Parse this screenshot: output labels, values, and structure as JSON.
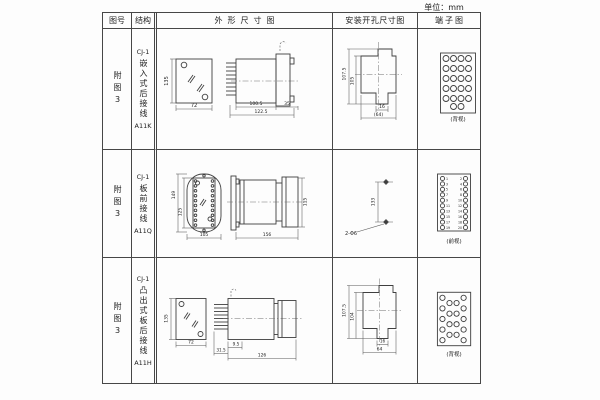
{
  "unit_label": "单位：mm",
  "headers": {
    "fig_no": "图号",
    "structure": "结构",
    "outline": "外形尺寸图",
    "mounting": "安装开孔尺寸图",
    "terminal": "端子图"
  },
  "rows": [
    {
      "fig_no": "附图3",
      "model": "CJ-1",
      "structure_text": "嵌入式后接线",
      "code": "A11K",
      "outline_dims": {
        "height": "135",
        "width": "72",
        "depth_body": "100.5",
        "depth_total": "122.5",
        "flange": "35"
      },
      "mounting_dims": {
        "outer": "107.5",
        "inner": "105",
        "notch": "16",
        "width": "(64)"
      },
      "terminal_caption": "(背视)"
    },
    {
      "fig_no": "附图3",
      "model": "CJ-1",
      "structure_text": "板前接线",
      "code": "A11Q",
      "outline_dims": {
        "height": "149",
        "inner_height": "125",
        "width": "105",
        "depth": "156",
        "cap_height": "115"
      },
      "mounting_dims": {
        "spacing": "133",
        "holes": "2-Φ6"
      },
      "terminal_caption": "(前视)",
      "terminal_numbers_left": [
        "1",
        "3",
        "5",
        "7",
        "9",
        "11",
        "13",
        "15",
        "17",
        "19"
      ],
      "terminal_numbers_right": [
        "2",
        "4",
        "6",
        "8",
        "10",
        "12",
        "14",
        "16",
        "18",
        "20"
      ]
    },
    {
      "fig_no": "附图3",
      "model": "CJ-1",
      "structure_text": "凸出式板后接线",
      "code": "A11H",
      "outline_dims": {
        "height": "135",
        "width": "72",
        "pin_depth": "31.5",
        "inset": "9.5",
        "depth": "126"
      },
      "mounting_dims": {
        "outer": "107.5",
        "inner": "104",
        "notch": "16",
        "width": "64"
      },
      "terminal_caption": "(背视)"
    }
  ]
}
